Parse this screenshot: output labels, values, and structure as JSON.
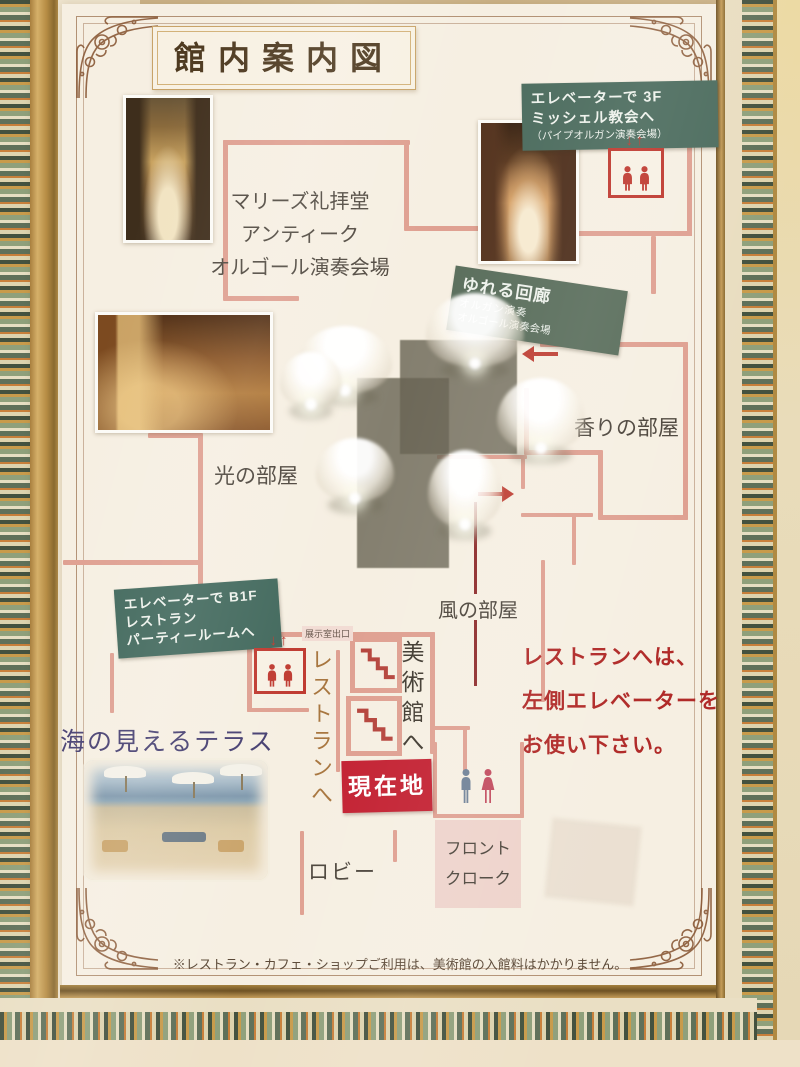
{
  "sign": {
    "title": "館内案内図",
    "footer_note": "※レストラン・カフェ・ショップご利用は、美術館の入館料はかかりません。"
  },
  "badges": {
    "elevator_3f": {
      "line1": "エレベーターで 3F",
      "line2": "ミッシェル教会へ",
      "line3": "（パイプオルガン演奏会場）"
    },
    "swaying_corridor": {
      "line1": "ゆれる回廊",
      "line2": "オルガン演奏",
      "line3": "オルゴール演奏会場"
    },
    "elevator_b1f": {
      "line1": "エレベーターで B1F",
      "line2": "レストラン",
      "line3": "パーティールームへ"
    }
  },
  "rooms": {
    "marys_chapel": {
      "line1": "マリーズ礼拝堂",
      "line2": "アンティーク",
      "line3": "オルゴール演奏会場"
    },
    "light_room": "光の部屋",
    "fragrance_room": "香りの部屋",
    "wind_room": "風の部屋",
    "lobby": "ロビー",
    "front_desk": {
      "line1": "フロント",
      "line2": "クローク"
    },
    "sea_terrace": "海の見えるテラス"
  },
  "wayfinding": {
    "current_location": "現在地",
    "to_museum": "美術館へ",
    "to_restaurant": "レストランへ",
    "exhibit_exit": "展示室出口",
    "elevator_arrows": "↓↑",
    "restaurant_notice": {
      "line1": "レストランへは、",
      "line2": "左側エレベーターを",
      "line3": "お使い下さい。"
    }
  },
  "colors": {
    "wall_salmon": "#dfa091",
    "accent_red": "#bf4136",
    "current_location_red": "#c32031",
    "badge_green": "#4c6c5e",
    "route_crimson": "#8e2c2c",
    "notice_red": "#b02a28",
    "terrace_title_purple": "#463f71"
  }
}
